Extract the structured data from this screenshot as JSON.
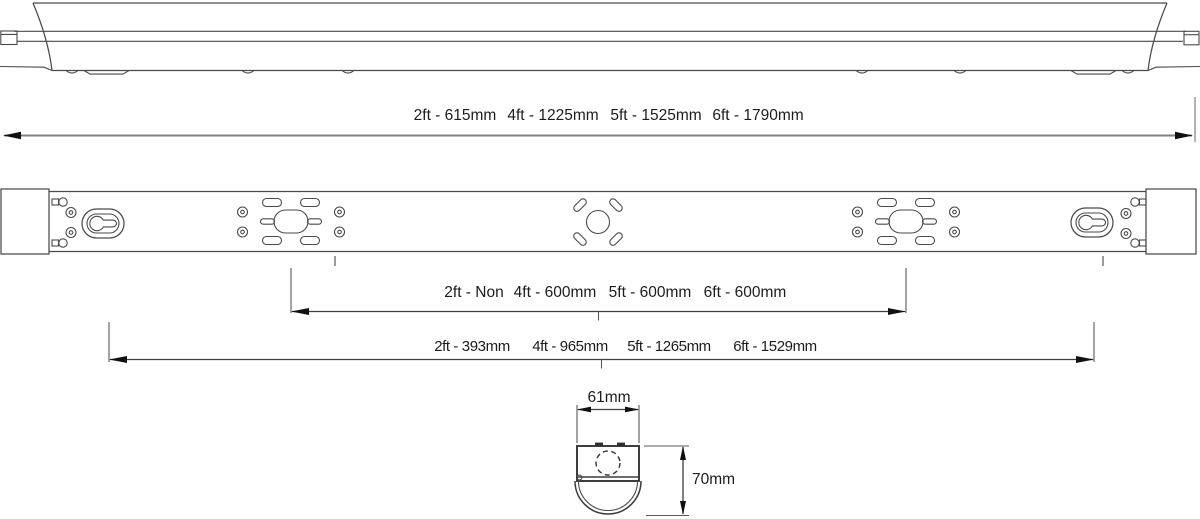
{
  "colors": {
    "drawing_line": "#4a4a4a",
    "dimension_line": "#3f3f3f",
    "overall_dimension_line": "#808080",
    "text": "#1c1c1c",
    "background": "#ffffff"
  },
  "dimensions": {
    "overall_length": {
      "segments": [
        "2ft - 615mm",
        "4ft - 1225mm",
        "5ft - 1525mm",
        "6ft - 1790mm"
      ]
    },
    "suspension_centres": {
      "segments": [
        "2ft - Non",
        "4ft - 600mm",
        "5ft - 600mm",
        "6ft - 600mm"
      ]
    },
    "fixing_centres": {
      "segments": [
        "2ft - 393mm",
        "4ft - 965mm",
        "5ft - 1265mm",
        "6ft - 1529mm"
      ]
    },
    "end_view_width": "61mm",
    "end_view_height": "70mm"
  }
}
